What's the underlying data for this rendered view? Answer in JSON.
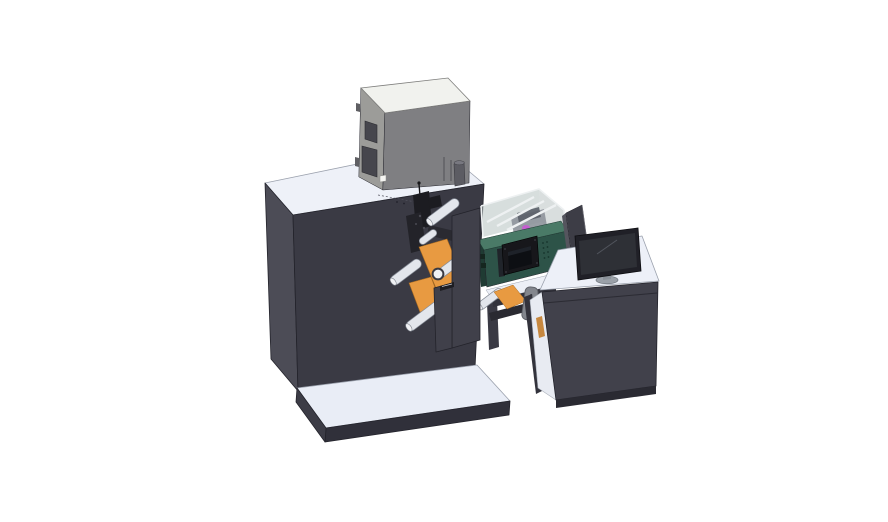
{
  "scene": {
    "type": "3d-cad-render",
    "subject": "label converting machine with electrical box, unwind rollers, inspection enclosure, control unit and operator desk",
    "background": "#ffffff"
  },
  "colors": {
    "bg": "#ffffff",
    "cabinet_top": "#eef1f8",
    "cabinet_left": "#4c4c56",
    "cabinet_front": "#3a3a44",
    "platform_top": "#e9edf6",
    "platform_front": "#30303a",
    "platform_left": "#3c3c46",
    "graybox_top": "#f1f2ee",
    "graybox_left": "#9c9c99",
    "graybox_front": "#7f7f82",
    "graybox_panel": "#46464d",
    "graybox_slot": "#5d5d60",
    "cylinder": "#5c5c63",
    "cylinder_top": "#787880",
    "black_part": "#1c1c21",
    "black_part2": "#232329",
    "rail_dark": "#2a2a31",
    "detail_hi": "#4a4a52",
    "orange": "#e89a41",
    "orange_dark": "#c37d2b",
    "roller": "#e3e6ec",
    "roller_cap": "#f0f1f4",
    "door": "#40404a",
    "label_chip": "#1d1d22",
    "glass": "#b7c2c1",
    "glass_side": "#aab6b5",
    "glass_frame": "#eef1f2",
    "mech_gray": "#8e939b",
    "mech_dark": "#5a5f68",
    "pink": "#c55fd0",
    "green_top": "#4a7a67",
    "green_front": "#2d5348",
    "green_edge": "#1f3b33",
    "vent": "#17332b",
    "hmi_bezel": "#17171b",
    "hmi_screen": "#0d0f13",
    "hmi_glare": "#262b33",
    "hmi_btn": "#20242a",
    "deck_top": "#eceff6",
    "deck_edge": "#33333c",
    "frame_dark": "#3a3a44",
    "handle": "#83868d",
    "divider_front": "#3d3d46",
    "divider_side": "#55555e",
    "desk_front": "#41414b",
    "desk_top": "#edf0f8",
    "desk_base": "#2a2a32",
    "desk_side_dark": "#33333c",
    "desk_interior": "#e8ebf2",
    "monitor_bezel": "#202027",
    "monitor_screen": "#2e3036",
    "monitor_glare": "#52555e",
    "stand": "#9aa0a8",
    "stand_base": "#8a9098"
  }
}
